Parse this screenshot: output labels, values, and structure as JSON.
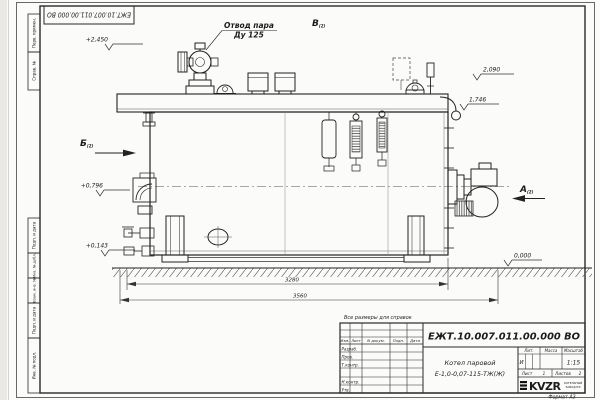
{
  "sheet": {
    "doc_number": "ЕЖТ.10.007.011.00.000  ВО",
    "format_label": "Формат А3",
    "reference_note": "Все размеры для справок"
  },
  "annotations": {
    "steam_outlet_line1": "Отвод пара",
    "steam_outlet_line2": "Ду 125",
    "view_a": "А",
    "view_b": "Б",
    "view_v": "В",
    "view_ref": "(2)",
    "elev_2450": "+2,450",
    "elev_2090": "2,090",
    "elev_1746": "1,746",
    "elev_0796": "+0,796",
    "elev_0143": "+0,143",
    "elev_0000": "0,000",
    "dim_inner": "3280",
    "dim_outer": "3560"
  },
  "title_block": {
    "product_name_line1": "Котел паровой",
    "product_name_line2": "Е-1,0-0,07-115-ТЖ(Ж)",
    "col_izm": "Изм.",
    "col_list": "Лист",
    "col_docnum": "N докум.",
    "col_podp": "Подп.",
    "col_data": "Дата",
    "row_razrab": "Разраб.",
    "row_prov": "Пров.",
    "row_tkontr": "Т.контр.",
    "row_nkontr": "Н.контр.",
    "row_utv": "Утв.",
    "lit_label": "Лит.",
    "mass_label": "Масса",
    "scale_label": "Масштаб",
    "lit_value": "И",
    "scale_value": "1:15",
    "sheet_label": "Лист",
    "sheet_value": "1",
    "sheets_label": "Листов",
    "sheets_value": "2",
    "logo_text": "KVZR",
    "logo_sub1": "КОТЕЛЬНЫЙ",
    "logo_sub2": "ЗАВОД РФ"
  },
  "margin_stamps": {
    "perv_primen": "Перв. примен.",
    "sprav_no": "Справ. №",
    "podp_data_1": "Подп. и дата",
    "inv_dubl": "Инв. № дубл.",
    "vzam_inv": "Взам. инв. №",
    "podp_data_2": "Подп. и дата",
    "inv_podl": "Инв. № подл."
  },
  "colors": {
    "line": "#222222",
    "thin": "#4a4a4a",
    "paper": "#fbfbf9"
  }
}
